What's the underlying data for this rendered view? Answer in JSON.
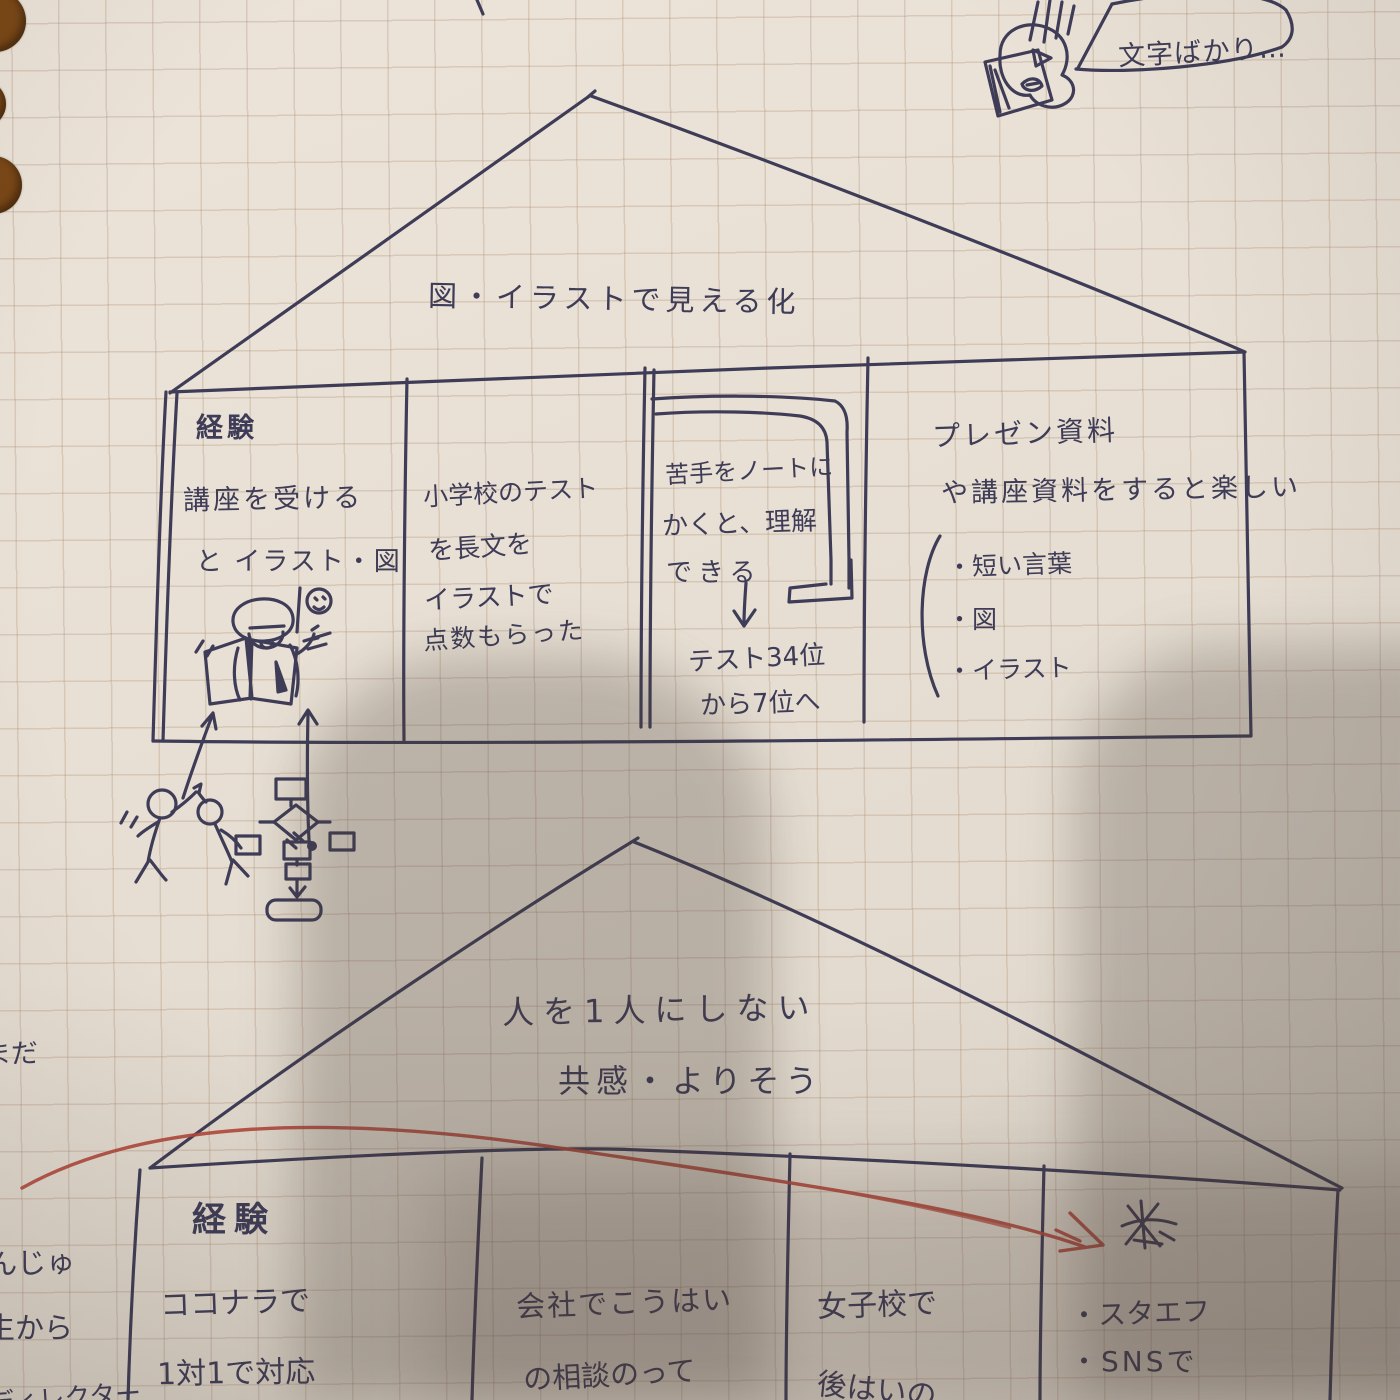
{
  "bubble": {
    "text": "文字ばかり…"
  },
  "upper_house": {
    "roof_title": "図・イラストで見える化",
    "room1": {
      "heading": "経験",
      "line1": "講座を受ける",
      "line2": "と イラスト・図"
    },
    "room2": {
      "line1": "小学校のテスト",
      "line2": "を長文を",
      "line3": "イラストで",
      "line4": "点数もらった"
    },
    "room3": {
      "line1": "苦手をノートに",
      "line2": "かくと、理解",
      "line3": "できる",
      "result1": "テスト34位",
      "result2": "から7位へ"
    },
    "room4": {
      "line1": "プレゼン資料",
      "line2": "や講座資料をすると楽しい",
      "bullet1": "・短い言葉",
      "bullet2": "・図",
      "bullet3": "・イラスト"
    }
  },
  "lower_house": {
    "roof_line1": "人を1人にしない",
    "roof_line2": "共感・よりそう",
    "room1": {
      "heading": "経験",
      "line1": "ココナラで",
      "line2": "1対1で対応"
    },
    "room2": {
      "line1": "会社でこうはい",
      "line2": "の相談のって"
    },
    "room3": {
      "line1": "女子校で",
      "line2": "後はいの"
    },
    "room4": {
      "bullet1": "・スタエフ",
      "bullet2": "・SNSで"
    }
  },
  "margin": {
    "frag1": "まだ",
    "frag2": "んじゅ",
    "frag3": "生から",
    "frag4": "ディレクター"
  },
  "doodles": {
    "top_right": "worried-face-reading-paper",
    "room1_upper": [
      "lightbulb",
      "person-reading-book"
    ],
    "below_upper_house": [
      "high-five-people",
      "flowchart"
    ],
    "room3_upper": "corner-pipe",
    "lower_room4": "scribbled-kanji-with-red-arrow"
  },
  "colors": {
    "ink": "#3e3c57",
    "red_pen": "#b2463a",
    "paper": "#e8e0d4",
    "binder_hole": "#7a4716"
  }
}
